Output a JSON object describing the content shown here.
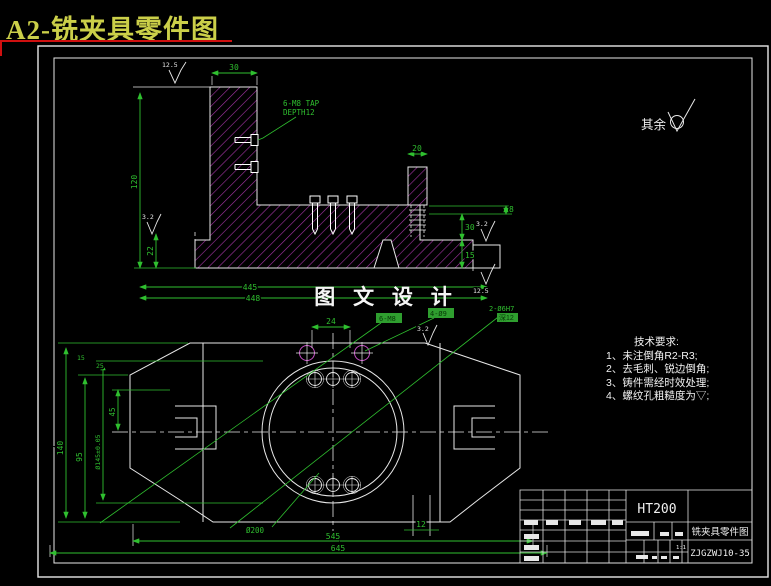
{
  "header": {
    "title": "A2-铣夹具零件图"
  },
  "colors": {
    "background": "#000000",
    "line_white": "#e8e8e8",
    "dim_green": "#2fbf2f",
    "hatch_magenta": "#a635a6",
    "title_yellow": "#cbcf49",
    "underline_red": "#cf1010"
  },
  "watermark": {
    "text": "图 文 设 计"
  },
  "surface_note": {
    "label": "其余"
  },
  "tech_requirements": {
    "title": "技术要求:",
    "items": [
      "1、未注倒角R2-R3;",
      "2、去毛刺、锐边倒角;",
      "3、铸件需经时效处理;",
      "4、螺纹孔粗糙度为▽;"
    ]
  },
  "upper_view": {
    "dims": {
      "top_width": "30",
      "left_height": "120",
      "step_height": "22",
      "surf_top": "12.5",
      "surf_left": "3.2",
      "surf_detail_top": "3.2",
      "surf_detail_bottom": "12.5",
      "boss_width": "20",
      "right_a": "8",
      "right_b": "30",
      "right_c": "15",
      "overall_a": "445",
      "overall_b": "448"
    },
    "notes": {
      "tap_line1": "6-M8 TAP",
      "tap_line2": "DEPTH12"
    }
  },
  "plan_view": {
    "dims": {
      "hole_pitch": "24",
      "inner_length": "545",
      "overall_length": "645",
      "circle_dia": "Ø200",
      "slot_width": "12",
      "total_height": "140",
      "inner_height": "95",
      "boss_dia": "Ø145±0.05",
      "half_height": "45",
      "small_a": "15",
      "small_b": "25",
      "surf": "3.2"
    },
    "labels": {
      "tap_holes": "6-M8",
      "through_holes": "4-Ø9",
      "dowel_line1": "2-Ø6H7",
      "dowel_line2": "深12"
    }
  },
  "title_block": {
    "material": "HT200",
    "drawing_title": "铣夹具零件图",
    "drawing_no": "ZJGZWJ10-35",
    "scale": "1:1"
  }
}
